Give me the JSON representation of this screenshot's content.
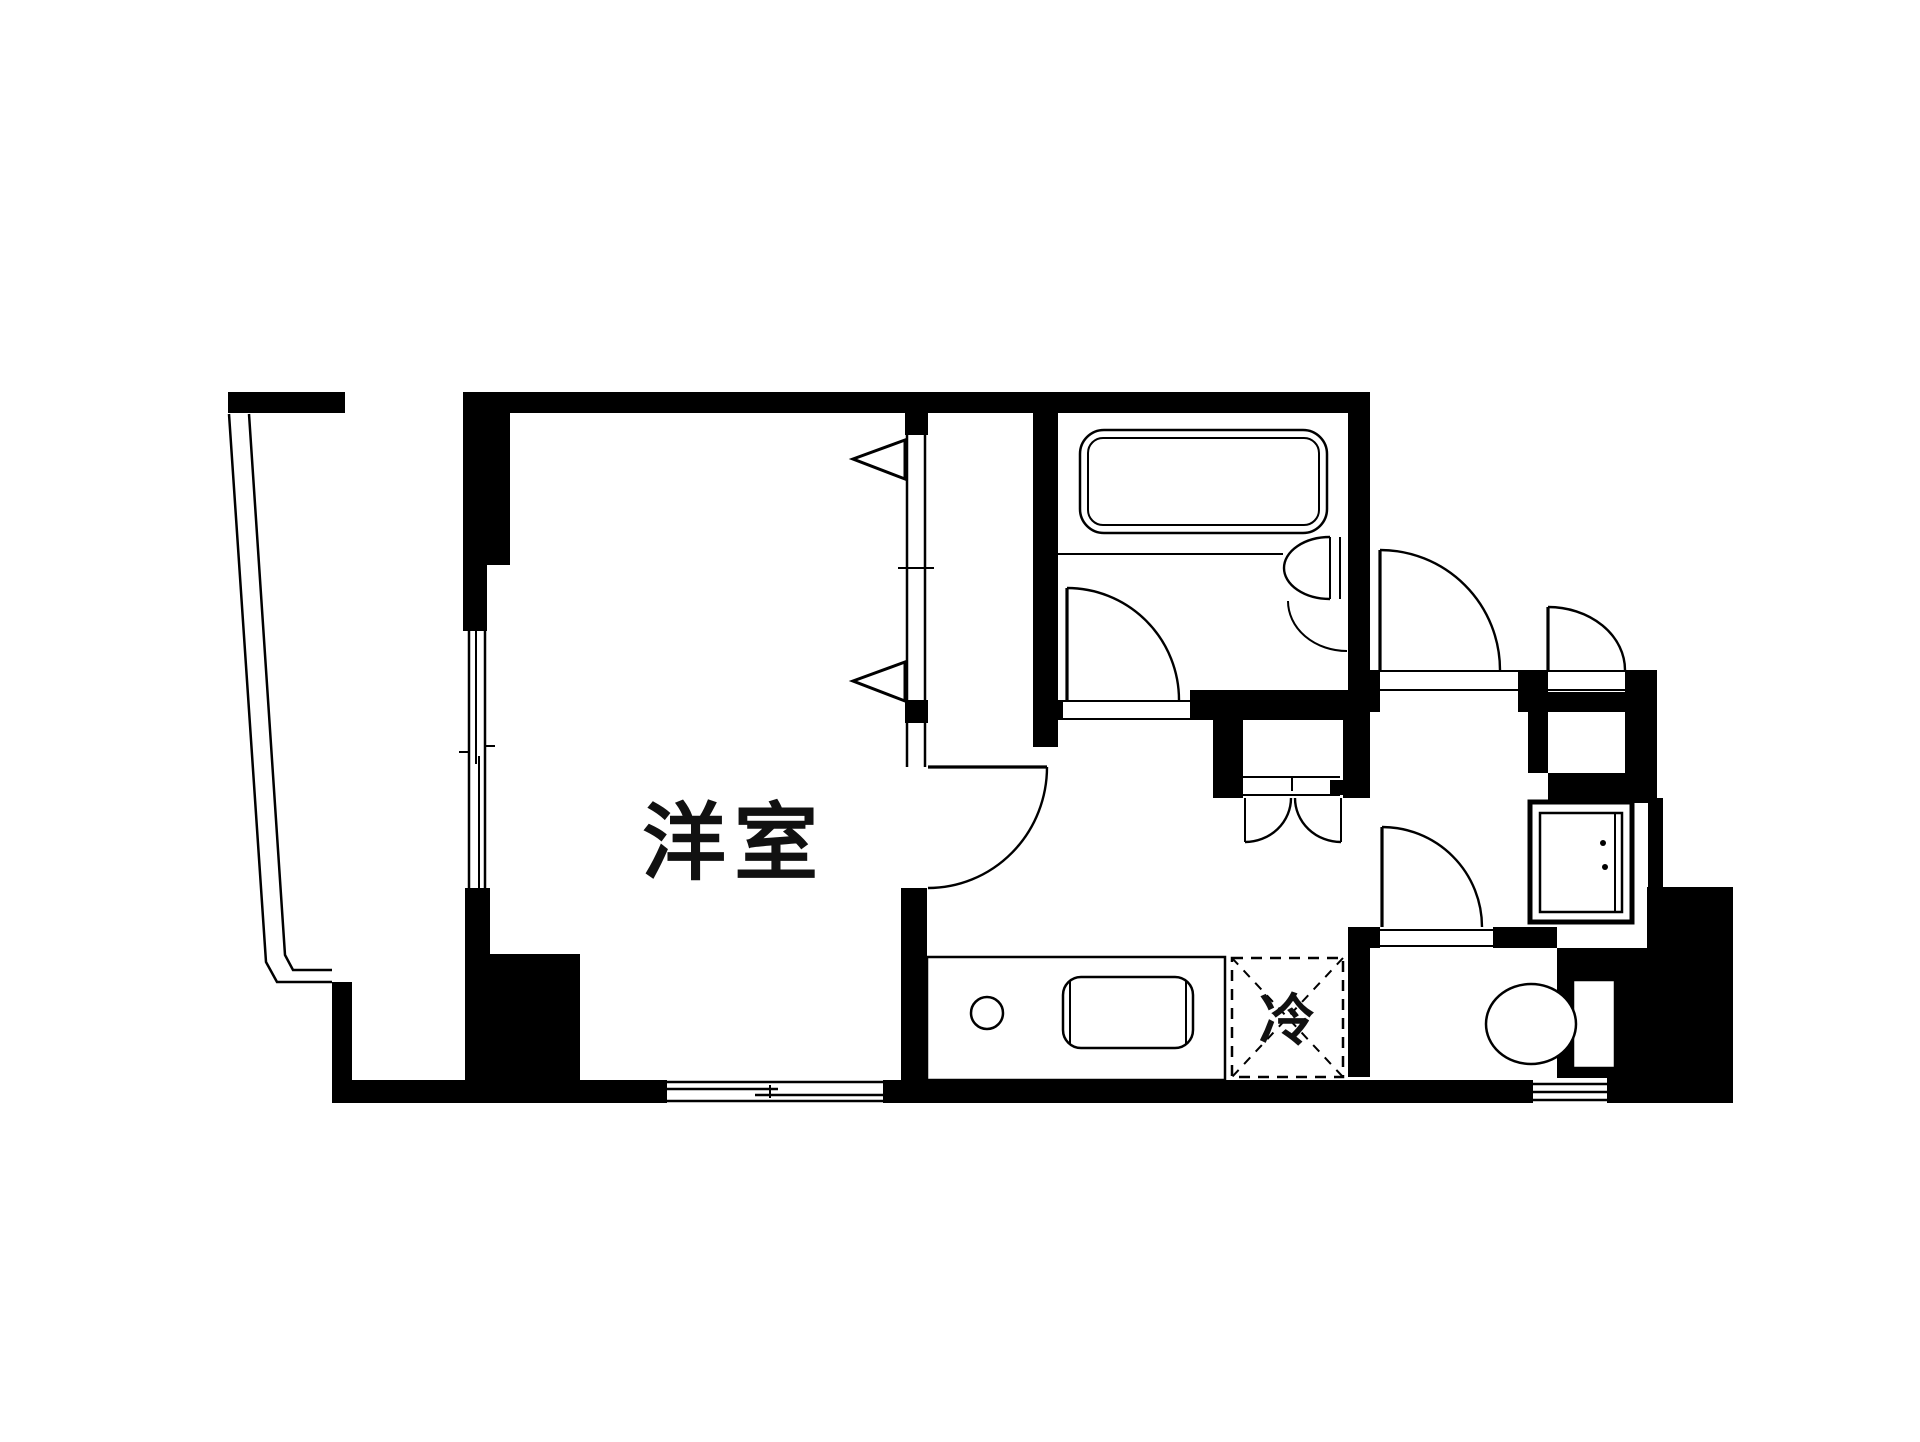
{
  "document": {
    "type": "japanese-apartment-floor-plan",
    "background_color": "#ffffff",
    "wall_color": "#000000",
    "text_color": "#111111"
  },
  "labels": {
    "main_room": "洋室",
    "refrigerator": "冷"
  },
  "rooms": [
    {
      "name": "western-room",
      "label": "洋室"
    },
    {
      "name": "balcony",
      "label": ""
    },
    {
      "name": "bathroom",
      "label": ""
    },
    {
      "name": "washroom",
      "label": ""
    },
    {
      "name": "kitchen-corridor",
      "label": ""
    },
    {
      "name": "refrigerator-space",
      "label": "冷"
    },
    {
      "name": "entrance-hall",
      "label": ""
    },
    {
      "name": "meter-box",
      "label": ""
    },
    {
      "name": "toilet-room",
      "label": ""
    }
  ],
  "fixtures": [
    "bathtub",
    "washbasin",
    "kitchen-sink",
    "stove-burner",
    "toilet",
    "washing-machine-pan",
    "hall-closet-double-door",
    "entrance-door",
    "meter-box-door",
    "room-door",
    "washroom-door",
    "toilet-door",
    "sliding-window-south",
    "sliding-window-top",
    "balcony-sliding-door",
    "balcony-railing",
    "entrance-step-grille"
  ]
}
